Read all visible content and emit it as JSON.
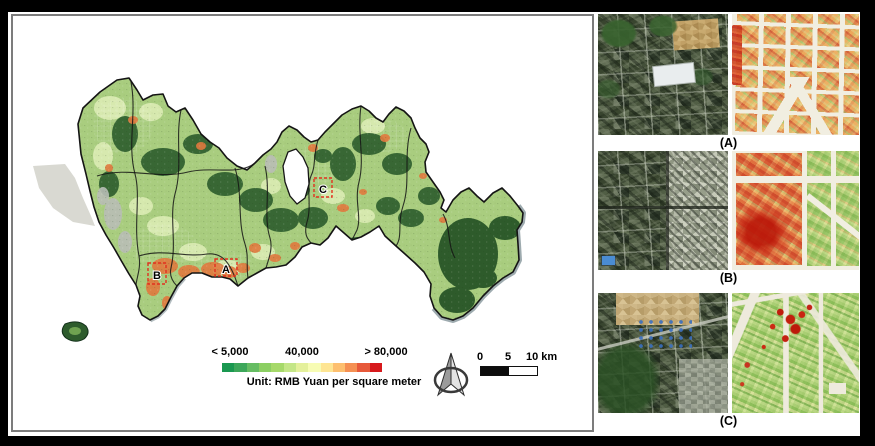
{
  "map": {
    "legend": {
      "min_label": "< 5,000",
      "mid_label": "40,000",
      "max_label": "> 80,000",
      "unit_label": "Unit: RMB Yuan per square meter",
      "colors": [
        "#1a9850",
        "#3da75a",
        "#66bd63",
        "#8ccf63",
        "#a6d96a",
        "#c4e687",
        "#e4f09b",
        "#f7fcb4",
        "#fee593",
        "#fdbf6f",
        "#f59053",
        "#e7593a",
        "#d7191c"
      ]
    },
    "scale_bar": {
      "ticks": [
        "0",
        "5",
        "10 km"
      ]
    },
    "markers": [
      {
        "label": "A"
      },
      {
        "label": "B"
      },
      {
        "label": "C"
      }
    ],
    "north_arrow_icon": "compass-north-arrow"
  },
  "panels": [
    {
      "label": "(A)"
    },
    {
      "label": "(B)"
    },
    {
      "label": "(C)"
    }
  ],
  "palette": {
    "price_low": "#1a9850",
    "price_mid": "#f7fcb4",
    "price_high": "#d7191c",
    "marker_box": "#e2301f",
    "frame": "#000000"
  }
}
